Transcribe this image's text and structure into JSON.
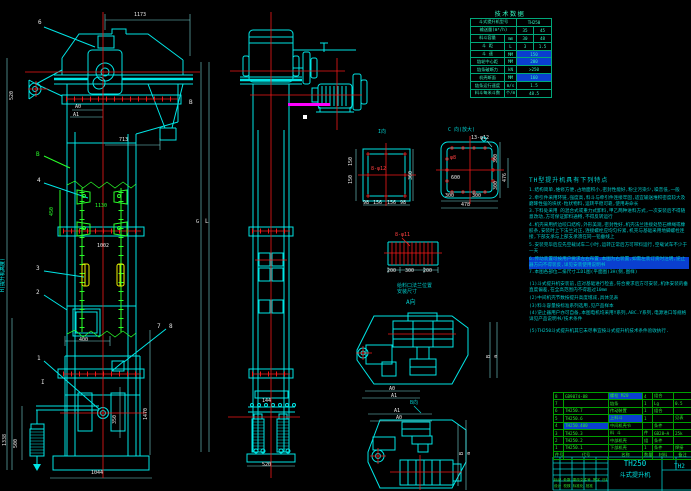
{
  "colors": {
    "linework": "#00e5e5",
    "centerline": "#f21818",
    "aux_green": "#2aff2a",
    "bucket_yellow": "#f0f000",
    "belt_magenta": "#ff00ff",
    "table_green": "#2fe82f",
    "tech_teal": "#35f5c0",
    "notes_teal": "#00c9c9",
    "selection_highlight": "#0a3fd0"
  },
  "tech_table": {
    "title": "技术数据",
    "rows": [
      [
        {
          "t": "斗式提升机型号",
          "s": 2
        },
        {
          "t": "TH250",
          "s": 2
        }
      ],
      [
        {
          "t": "输送量(m³/h)",
          "s": 2
        },
        {
          "t": "35"
        },
        {
          "t": "45"
        }
      ],
      [
        {
          "t": "料斗容量"
        },
        {
          "t": "mm"
        },
        {
          "t": "30"
        },
        {
          "t": "48"
        }
      ],
      [
        {
          "t": "斗 距"
        },
        {
          "t": "L"
        },
        {
          "t": "3"
        },
        {
          "t": "1.5"
        }
      ],
      [
        {
          "t": "斗 速"
        },
        {
          "t": "MM"
        },
        {
          "t": "150",
          "s": 2,
          "hl": true
        }
      ],
      [
        {
          "t": "链轮中心距"
        },
        {
          "t": "MM"
        },
        {
          "t": "200",
          "s": 2,
          "hl": true
        }
      ],
      [
        {
          "t": "链条破断力"
        },
        {
          "t": "kN"
        },
        {
          "t": ">250",
          "s": 2
        }
      ],
      [
        {
          "t": "机壳断面"
        },
        {
          "t": "MM"
        },
        {
          "t": "160",
          "s": 2,
          "hl": true
        }
      ],
      [
        {
          "t": "链条运行速度"
        },
        {
          "t": "m/s"
        },
        {
          "t": "1.5",
          "s": 2
        }
      ],
      [
        {
          "t": "料斗每米斗数"
        },
        {
          "t": "个/m"
        },
        {
          "t": "48.5",
          "s": 2
        }
      ]
    ]
  },
  "notes": {
    "header": "TH型提升机具有下列特点",
    "items": [
      {
        "text": "1.结构简单,维修方便,占地面积小,密封性能好,粉尘污染少,噪音低,一般"
      },
      {
        "text": "2.牵引件采用环链,强度高,料斗与牵引件连接牢固,适宜输送堆积密度较大及磨琢性强的块状-粒状物料,运转平稳可靠,使用寿命长"
      },
      {
        "text": "3.下料处采用 的混合式或重力式卸料,甲乙两种进料方式,一次安装后不得随意改动,方可保证卸料通畅,不得反转运行"
      },
      {
        "text": "4.机壳采用折边咬口结构,外形美观,密封性好,机壳法兰连接处垫石棉绳或橡胶条,安装时上下法兰对正,连接螺栓应均匀拧紧,机壳与基础采用地脚螺栓连接,下部支承与上部支承须在同一铅垂线上"
      },
      {
        "text": "5.安装完毕后应先空载试车二小时,运转正常后方可带料运行,空载试车不少于一天"
      },
      {
        "text": "6.传动装置可按用户要求左右布置,本图为右装置,如需左装订货时注明,逆止器方向不得装反,详见安装使用说明书",
        "hl": true
      },
      {
        "text": "7.本图各部位二排尺寸工D1图(平面图)3H(侧,图样)"
      }
    ],
    "sub_items": [
      {
        "text": "(1)斗式提升机安装前,应对基础进行检查,符合要求后方可安装,机体安装的垂直度偏差,在全高范围内不得超过10mm"
      },
      {
        "text": "(2)中间机壳节数按提升高度增减,具体见表"
      },
      {
        "text": "(3)料斗容量按标准系列选用,见产品样本"
      },
      {
        "text": "(4)逆止器用户亦可自备,本图电机均采用Y系列,ABC.Y系列,电源进口等规格详见产品说明书/技术条件"
      }
    ],
    "footer": "(5)TH250斗式提升机其它未尽事宜按斗式提升机技术条件验收执行."
  },
  "parts_table": {
    "header": [
      "件号",
      "代号",
      "名称",
      "数量",
      "材料",
      "备注"
    ],
    "rows": [
      [
        "8",
        "GB9074-88",
        "螺栓 M20",
        "4",
        "组合",
        ""
      ],
      [
        "7",
        "",
        "链条",
        "1",
        "Lg",
        "0.5"
      ],
      [
        "6",
        "TH250.7",
        "传动装置",
        "1",
        "组合",
        ""
      ],
      [
        "5",
        "TH250.6",
        "上料斗",
        "1",
        "",
        "见表"
      ],
      [
        "4",
        "TH250.400",
        "中间机壳节",
        "",
        "条件",
        ""
      ],
      [
        "3",
        "TH250.3",
        "料 斗",
        "件",
        "GB28—A",
        "25k"
      ],
      [
        "2",
        "TH250.2",
        "中部机壳",
        "组",
        "条件",
        ""
      ],
      [
        "1",
        "TH250.1",
        "下部机壳",
        "1",
        "条件",
        "焊接"
      ]
    ],
    "hl_cells": [
      [
        0,
        2
      ],
      [
        3,
        2
      ],
      [
        4,
        1
      ]
    ]
  },
  "title_block": {
    "model": "TH250",
    "product": "斗式提升机",
    "doc_fragment": "TH2",
    "revision_row": "标记 处数 更改文件号 签字 日期",
    "approval_row": "设计 校核 标准化 批准"
  },
  "labels": [
    {
      "t": "1173",
      "x": 134,
      "y": 13
    },
    {
      "t": "6",
      "x": 38,
      "y": 20,
      "s": 6
    },
    {
      "t": "520",
      "x": 10,
      "y": 100,
      "r": 1
    },
    {
      "t": "B",
      "x": 189,
      "y": 100,
      "s": 6
    },
    {
      "t": "A0",
      "x": 75,
      "y": 105
    },
    {
      "t": "A1",
      "x": 73,
      "y": 113
    },
    {
      "t": "713",
      "x": 119,
      "y": 138
    },
    {
      "t": "B",
      "x": 36,
      "y": 152,
      "c": "g",
      "s": 6
    },
    {
      "t": "4",
      "x": 37,
      "y": 178,
      "s": 6
    },
    {
      "t": "450",
      "x": 50,
      "y": 216,
      "c": "g",
      "r": 1
    },
    {
      "t": "1130",
      "x": 95,
      "y": 204,
      "c": "g"
    },
    {
      "t": "G",
      "x": 196,
      "y": 220
    },
    {
      "t": "L",
      "x": 205,
      "y": 219,
      "s": 6
    },
    {
      "t": "1002",
      "x": 97,
      "y": 244
    },
    {
      "t": "3",
      "x": 36,
      "y": 266,
      "s": 6
    },
    {
      "t": "2",
      "x": 36,
      "y": 290,
      "s": 6
    },
    {
      "t": "H(提升机高度)",
      "x": 1,
      "y": 292,
      "c": "c",
      "r": 1
    },
    {
      "t": "400",
      "x": 79,
      "y": 338
    },
    {
      "t": "7",
      "x": 157,
      "y": 324,
      "s": 6
    },
    {
      "t": "8",
      "x": 169,
      "y": 324,
      "s": 6
    },
    {
      "t": "1",
      "x": 37,
      "y": 356,
      "s": 6
    },
    {
      "t": "I",
      "x": 41,
      "y": 380,
      "s": 6
    },
    {
      "t": "1338",
      "x": 3,
      "y": 446,
      "r": 1
    },
    {
      "t": "500",
      "x": 14,
      "y": 448,
      "r": 1
    },
    {
      "t": "350",
      "x": 113,
      "y": 424,
      "r": 1
    },
    {
      "t": "1470",
      "x": 144,
      "y": 420,
      "r": 1
    },
    {
      "t": "1044",
      "x": 91,
      "y": 471
    },
    {
      "t": "144",
      "x": 262,
      "y": 399
    },
    {
      "t": "520",
      "x": 262,
      "y": 463
    },
    {
      "t": "I向",
      "x": 378,
      "y": 130,
      "c": "t"
    },
    {
      "t": "150",
      "x": 349,
      "y": 166,
      "r": 1
    },
    {
      "t": "150",
      "x": 349,
      "y": 184,
      "r": 1
    },
    {
      "t": "360",
      "x": 409,
      "y": 180,
      "r": 1
    },
    {
      "t": "8-φ12",
      "x": 371,
      "y": 167,
      "c": "r"
    },
    {
      "t": "98",
      "x": 363,
      "y": 201
    },
    {
      "t": "156",
      "x": 373,
      "y": 201
    },
    {
      "t": "156",
      "x": 387,
      "y": 201
    },
    {
      "t": "98",
      "x": 400,
      "y": 201
    },
    {
      "t": "C 向(放大)",
      "x": 448,
      "y": 128,
      "c": "t"
    },
    {
      "t": "13-φ12",
      "x": 471,
      "y": 136
    },
    {
      "t": "φ8",
      "x": 450,
      "y": 156,
      "c": "r"
    },
    {
      "t": "600",
      "x": 451,
      "y": 176
    },
    {
      "t": "300",
      "x": 494,
      "y": 163,
      "r": 1
    },
    {
      "t": "300",
      "x": 494,
      "y": 190,
      "r": 1
    },
    {
      "t": "476",
      "x": 503,
      "y": 182,
      "r": 1
    },
    {
      "t": "300",
      "x": 445,
      "y": 194
    },
    {
      "t": "300",
      "x": 472,
      "y": 194
    },
    {
      "t": "478",
      "x": 461,
      "y": 203
    },
    {
      "t": "8-φ11",
      "x": 395,
      "y": 233,
      "c": "r"
    },
    {
      "t": "200",
      "x": 387,
      "y": 269
    },
    {
      "t": "300",
      "x": 405,
      "y": 269
    },
    {
      "t": "200",
      "x": 423,
      "y": 269
    },
    {
      "t": "给料口法兰位置",
      "x": 397,
      "y": 284,
      "c": "t"
    },
    {
      "t": "安装尺寸",
      "x": 397,
      "y": 290,
      "c": "t"
    },
    {
      "t": "A向",
      "x": 406,
      "y": 300,
      "c": "t",
      "s": 6
    },
    {
      "t": "B",
      "x": 487,
      "y": 358,
      "r": 1
    },
    {
      "t": "a",
      "x": 494,
      "y": 358,
      "r": 1
    },
    {
      "t": "A0",
      "x": 389,
      "y": 387
    },
    {
      "t": "A1",
      "x": 391,
      "y": 394
    },
    {
      "t": "B向",
      "x": 410,
      "y": 401,
      "c": "t"
    },
    {
      "t": "A1",
      "x": 394,
      "y": 409
    },
    {
      "t": "A0",
      "x": 396,
      "y": 416
    },
    {
      "t": "B",
      "x": 460,
      "y": 455,
      "r": 1
    },
    {
      "t": "a",
      "x": 467,
      "y": 455,
      "r": 1
    }
  ]
}
